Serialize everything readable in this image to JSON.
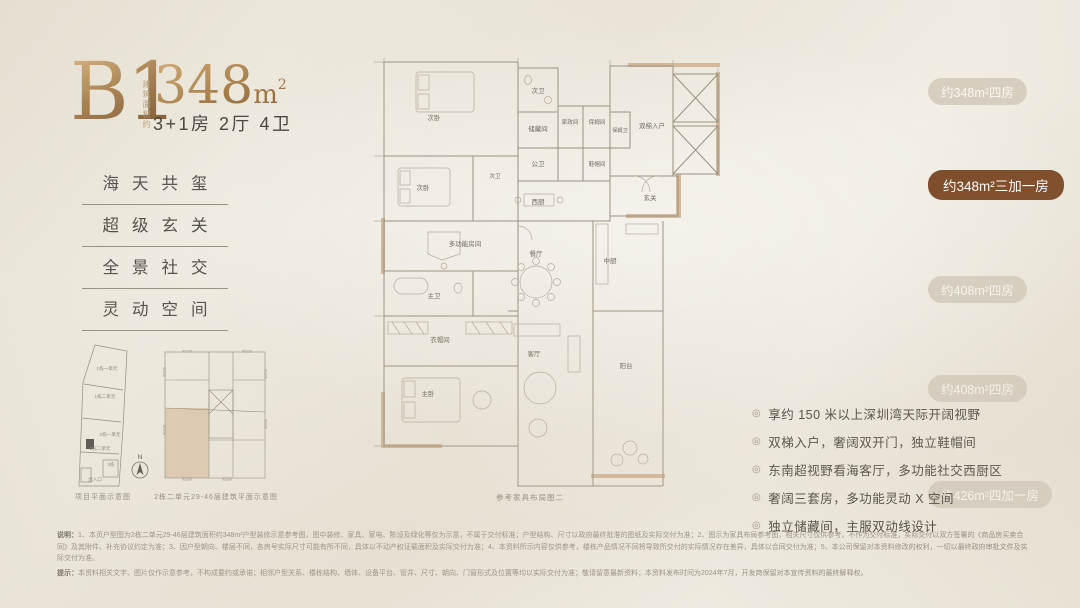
{
  "header": {
    "plan_code": "B1",
    "area_prefix_vertical": "建筑面积约",
    "area_value": "348",
    "area_unit": "m",
    "area_sup": "2",
    "layout_line": "3+1房 2厅 4卫"
  },
  "features": [
    "海天共玺",
    "超级玄关",
    "全景社交",
    "灵动空间"
  ],
  "badges": [
    {
      "label": "约348m²四房",
      "active": false
    },
    {
      "label": "约348m²三加一房",
      "active": true
    },
    {
      "label": "约408m²四房",
      "active": false
    },
    {
      "label": "约408m²四房",
      "active": false
    },
    {
      "label": "约426m²四加一房",
      "active": false
    }
  ],
  "floorplan": {
    "caption": "参考家具布局图二",
    "rooms": [
      "次卧",
      "次卫",
      "储藏间",
      "家政间",
      "保姆间",
      "保姆卫",
      "双梯入户",
      "公卫",
      "鞋帽间",
      "玄关",
      "次卧",
      "次卫",
      "西厨",
      "多功能房间",
      "餐厅",
      "中厨",
      "主卫",
      "衣帽间",
      "主卧",
      "客厅",
      "阳台"
    ]
  },
  "minimaps": {
    "site_caption": "项目平面示意图",
    "site_labels": [
      "1栋一单元",
      "1栋二单元",
      "2栋一单元",
      "2栋二单元",
      "3栋",
      "出入口"
    ],
    "tower_caption": "2栋二单元29-46层建筑平面示意图",
    "north_label": "N"
  },
  "bullets": [
    "享约 150 米以上深圳湾天际开阔视野",
    "双梯入户，奢阔双开门，独立鞋帽间",
    "东南超视野看海客厅，多功能社交西厨区",
    "奢阔三套房，多功能灵动 X 空间",
    "独立储藏间，主服双动线设计"
  ],
  "disclaimer": {
    "p1_lead": "说明：",
    "p1": "1、本页户型图为2栋二单元29-46层建筑面积约348m²户型装修示意参考图，图中装修、家具、家电、陈设及绿化等仅为示意，不属于交付标准；户型结构、尺寸以政府最终批准的图纸及实际交付为准；2、图示为家具布局参考图，相关尺寸仅供参考，不作为交付标准，实际交付以双方签署的《商品房买卖合同》及其附件、补充协议约定为准；3、因户型朝向、楼层不同，各房号实际尺寸可能有所不同，具体以不动产权证载面积及实际交付为准；4、本资料所示内容仅供参考，楼栋产品情况不同将导致所交付的实际情况存在差异，具体以合同交付为准；5、本公司保留对本资料修改的权利，一切以最终政府审批文件及实际交付为准。",
    "p2_lead": "提示：",
    "p2": "本资料相关文字、图片仅作示意参考，不构成要约或承诺；相邻户型关系、楼栋结构、墙体、设备平台、管井、尺寸、朝向、门窗形式及位置等均以实际交付为准；敬请留意最新资料；本资料发布时间为2024年7月，开发商保留对本宣传资料的最终解释权。"
  },
  "colors": {
    "accent_dark": "#7c4a27",
    "accent_gold": "#a57c4b",
    "pill_light": "#d6cfc0"
  }
}
